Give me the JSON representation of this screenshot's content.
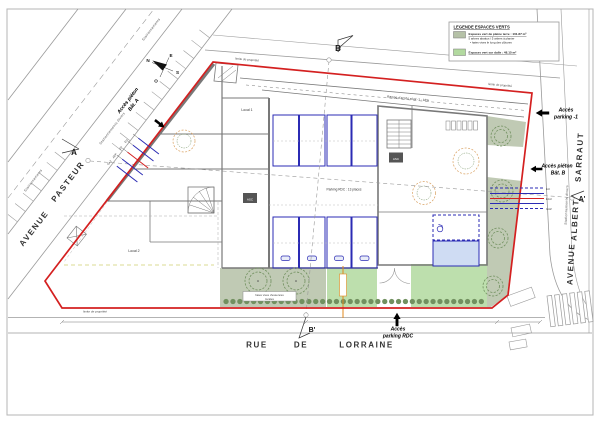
{
  "legend": {
    "title": "LEGENDE ESPACES VERTS",
    "item1_label": "Espaces vert de pleine terre : 101.87 m²",
    "item1_line2": "5 arbres abattus / 5 arbres à planter",
    "item1_line3": "•  haies vives le long des clôtures",
    "item2_label": "Espaces vert sur dalle : 48.15 m²"
  },
  "streets": {
    "pasteur_word1": "AVENUE",
    "pasteur_word2": "PASTEUR",
    "sarraut_word1": "AVENUE",
    "sarraut_word2": "ALBERT",
    "sarraut_word3": "SARRAUT",
    "lorraine_word1": "RUE",
    "lorraine_word2": "DE",
    "lorraine_word3": "LORRAINE",
    "stationnements": "Stationnements",
    "stationnements_divers": "Stationnements divers"
  },
  "compass": {
    "n": "N",
    "e": "E",
    "s": "S",
    "o": "O"
  },
  "sections": {
    "a": "A",
    "a_prime": "A'",
    "b": "B",
    "b_prime": "B'"
  },
  "access": {
    "pieton_a_1": "Accès piéton",
    "pieton_a_2": "Bât. A",
    "pieton_b_1": "Accès piéton",
    "pieton_b_2": "Bât. B",
    "parking_m1_1": "Accès",
    "parking_m1_2": "parking -1",
    "parking_rdc_1": "Accès",
    "parking_rdc_2": "parking RDC"
  },
  "site": {
    "limite": "limite de propriété",
    "rampe": "Rampe d'accès s/sol -1 : 18%",
    "parking_rdc": "Parking RDC : 13 places",
    "local1": "Local 1",
    "local2": "Local 2",
    "asc": "ASC",
    "haies_1": "haies vives d'essences",
    "haies_2": "locales"
  },
  "utilities": {
    "eu": "EU",
    "eau": "EAU",
    "gaz": "GAZ",
    "ep": "EP",
    "aep": "AEP"
  },
  "colors": {
    "boundary_red": "#d42020",
    "parking_blue": "#2b2bb4",
    "parking_blue_fill": "#cfdcf3",
    "green_pleine_terre": "#b5c1a7",
    "green_sur_dalle": "#b2d99f",
    "hedge_green": "#71905f",
    "utility_orange": "#e0891e",
    "wall_gray": "#787878"
  }
}
